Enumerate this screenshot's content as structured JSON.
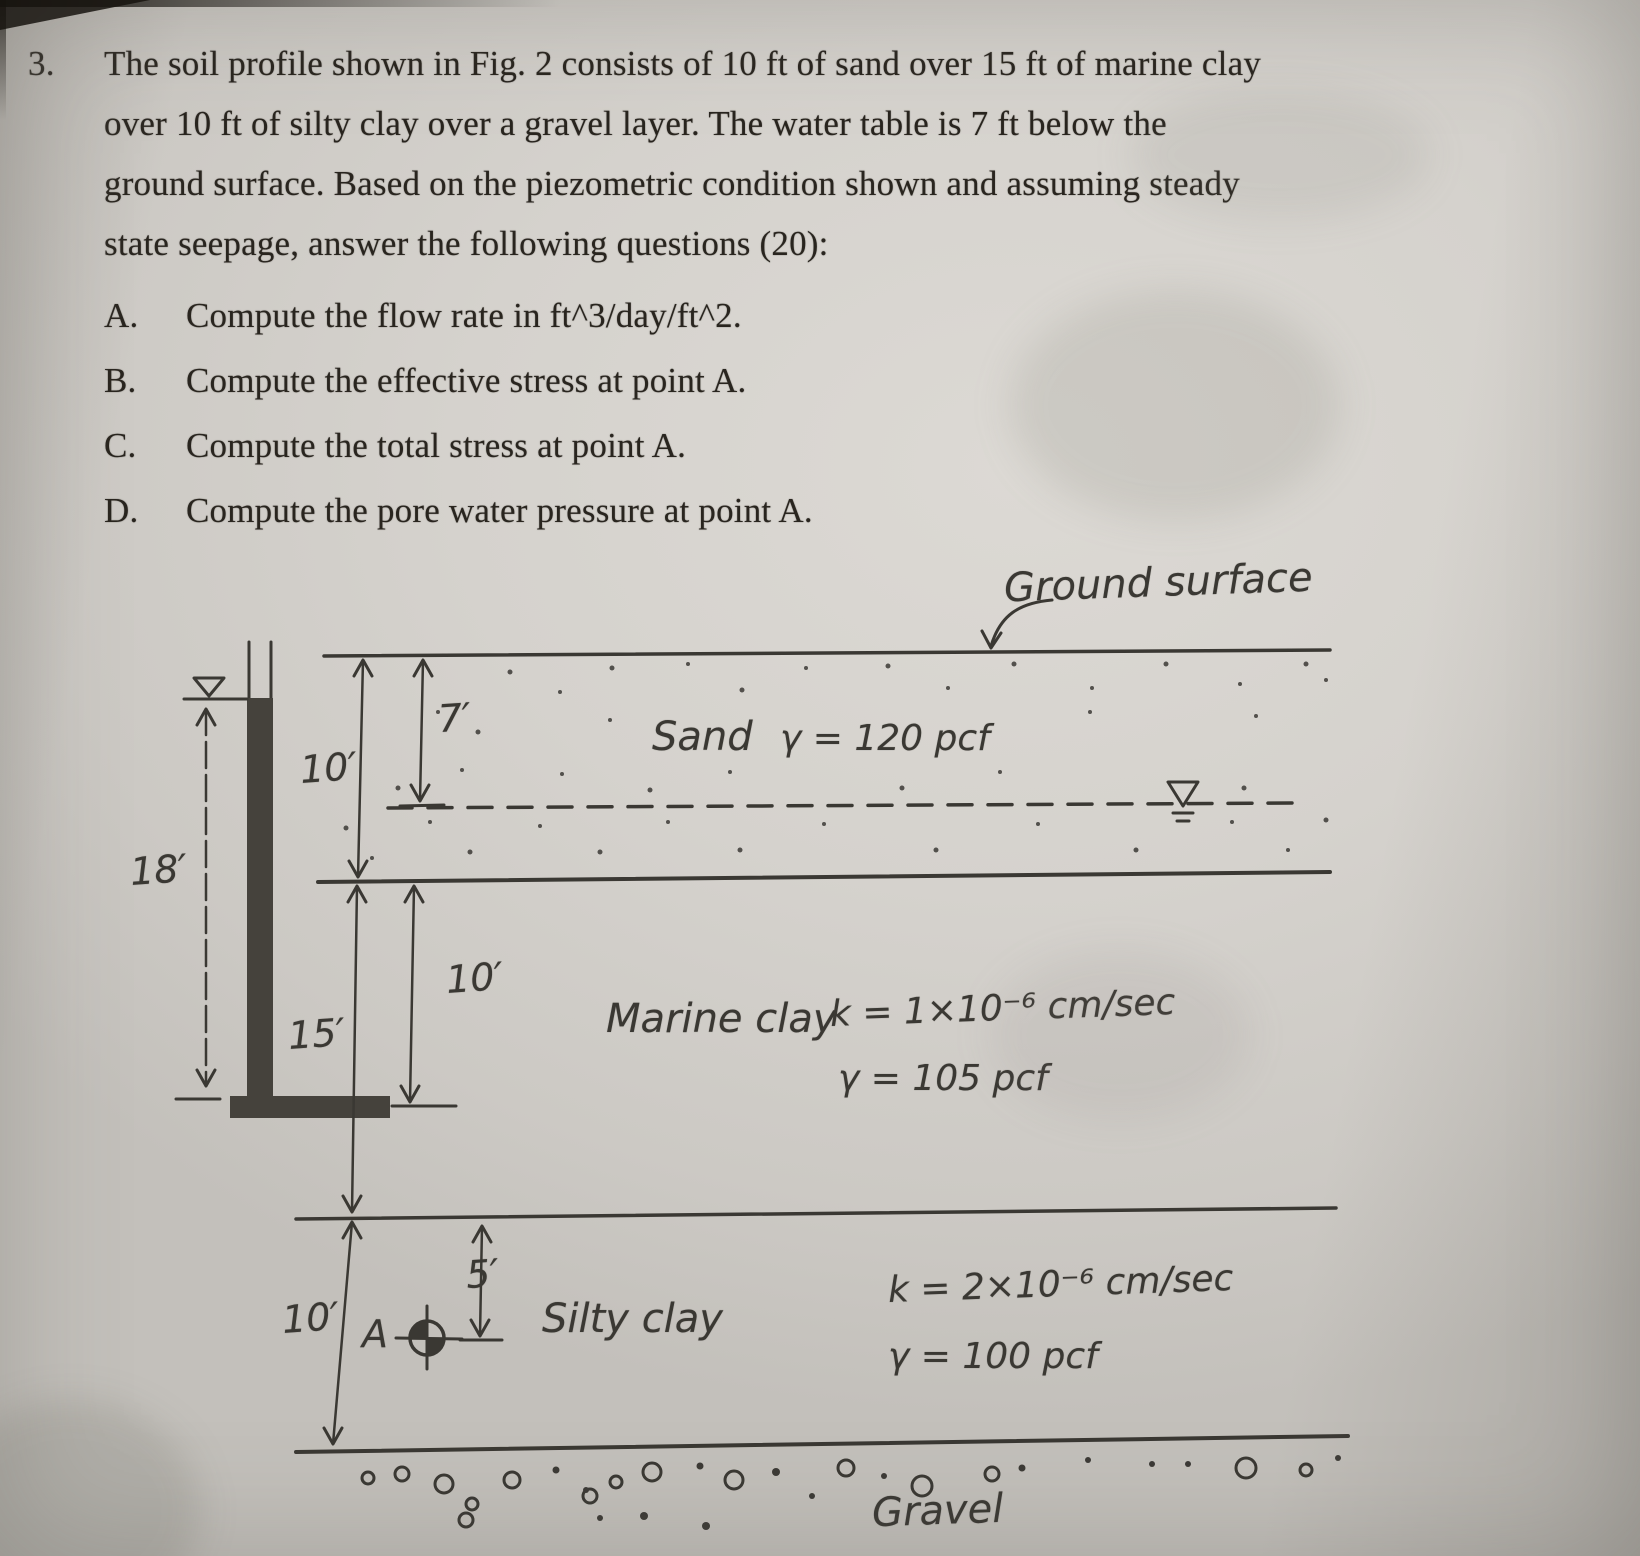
{
  "page": {
    "number": "3.",
    "paragraph": [
      "The soil profile shown in Fig. 2 consists of 10 ft of sand over 15 ft of marine clay",
      "over 10 ft of silty clay over a gravel layer. The water table is 7 ft below the",
      "ground surface. Based on the piezometric condition shown and assuming steady",
      "state seepage, answer the following questions (20):"
    ],
    "items": [
      {
        "label": "A.",
        "text": "Compute the flow rate in ft^3/day/ft^2."
      },
      {
        "label": "B.",
        "text": "Compute the effective stress at point A."
      },
      {
        "label": "C.",
        "text": "Compute the total stress at point A."
      },
      {
        "label": "D.",
        "text": "Compute the pore water pressure at point A."
      }
    ]
  },
  "figure": {
    "ground_surface_label": "Ground surface",
    "gravel_label": "Gravel",
    "point_a_label": "A",
    "sand": {
      "name": "Sand",
      "unit_weight": "γ = 120 pcf"
    },
    "marine_clay": {
      "name": "Marine clay",
      "permeability": "k = 1×10⁻⁶ cm/sec",
      "unit_weight": "γ = 105 pcf"
    },
    "silty_clay": {
      "name": "Silty clay",
      "permeability": "k = 2×10⁻⁶ cm/sec",
      "unit_weight": "γ = 100 pcf"
    },
    "dims": {
      "head_18": "18′",
      "sand_10": "10′",
      "wt_7": "7′",
      "marine_15": "15′",
      "marine_10": "10′",
      "silty_10": "10′",
      "a_5": "5′"
    }
  },
  "colors": {
    "ink": "#3a3833",
    "print": "#29251f",
    "paper": "#d5d2cd"
  }
}
